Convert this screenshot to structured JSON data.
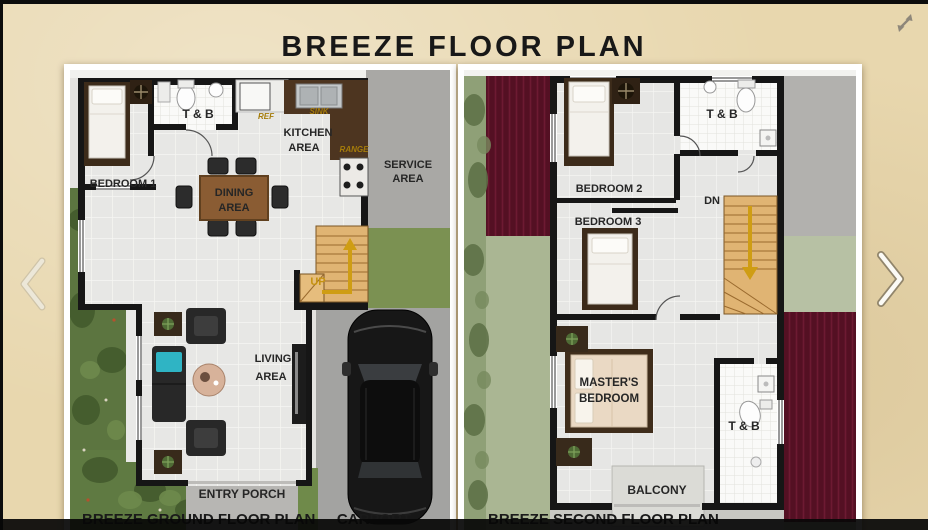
{
  "title": "BREEZE FLOOR PLAN",
  "nav": {
    "prev_icon": "chevron-left",
    "next_icon": "chevron-right",
    "expand_icon": "diagonal-expand-arrow"
  },
  "ground_floor": {
    "caption": "BREEZE GROUND FLOOR PLAN",
    "carport_label": "CARPORT",
    "rooms": {
      "bedroom1": "BEDROOM 1",
      "toilet_bath": "T & B",
      "kitchen_l1": "KITCHEN",
      "kitchen_l2": "AREA",
      "service_l1": "SERVICE",
      "service_l2": "AREA",
      "dining_l1": "DINING",
      "dining_l2": "AREA",
      "living_l1": "LIVING",
      "living_l2": "AREA",
      "stairs_up": "UP",
      "entry_porch": "ENTRY PORCH",
      "ref": "REF",
      "sink": "SINK",
      "range": "RANGE"
    }
  },
  "second_floor": {
    "caption": "BREEZE SECOND FLOOR PLAN",
    "rooms": {
      "bedroom2": "BEDROOM 2",
      "bedroom3": "BEDROOM 3",
      "toilet_bath_upper": "T & B",
      "toilet_bath_lower": "T & B",
      "stairs_down": "DN",
      "master_l1": "MASTER'S",
      "master_l2": "BEDROOM",
      "balcony": "BALCONY"
    }
  },
  "colors": {
    "background_tan": "#e8d7ae",
    "frame_white": "#ffffff",
    "wall_black": "#161616",
    "garden_dark_green": "#5c7540",
    "garden_pale_green": "#aab693",
    "concrete_gray": "#a9a8a5",
    "roof_maroon": "#541023",
    "counter_brown": "#4d3520",
    "table_wood": "#8a5c33",
    "stair_wood": "#e0b473",
    "gold_accent": "#cf9d13",
    "overlay_black": "#080808"
  }
}
